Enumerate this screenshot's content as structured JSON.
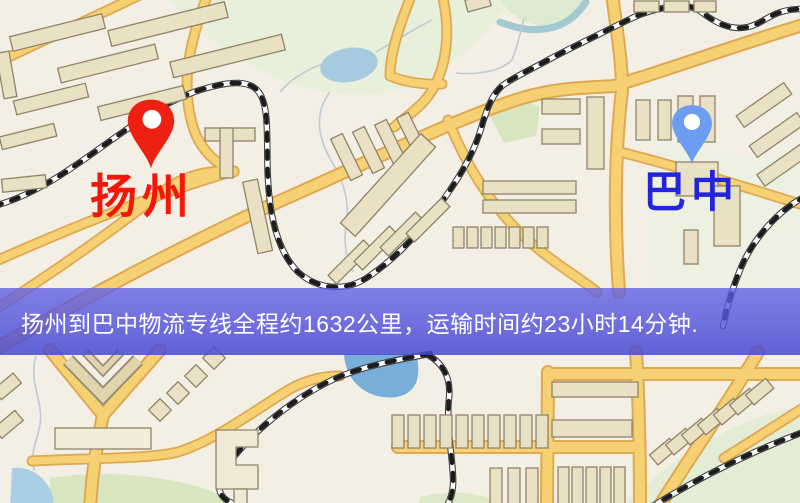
{
  "map": {
    "type": "static-road-map",
    "background_color": "#f3efe4",
    "road_color": "#f5d173",
    "road_casing_color": "#dfa852",
    "railway_color": "#1c1c1c",
    "water_color": "#a6cbdf",
    "green_area_color": "#e8efdb",
    "building_color": "#eae1c4",
    "origin": {
      "name": "扬州",
      "pin_color": "#ee2012",
      "label_color": "#f5160a"
    },
    "destination": {
      "name": "巴中",
      "pin_color": "#6d9df1",
      "label_color": "#2424dc"
    }
  },
  "banner": {
    "text": "扬州到巴中物流专线全程约1632公里，运输时间约23小时14分钟.",
    "background_color": "rgba(86,86,224,0.8)",
    "text_color": "#ffffff",
    "distance_km": "1632",
    "duration": "23小时14分钟"
  }
}
